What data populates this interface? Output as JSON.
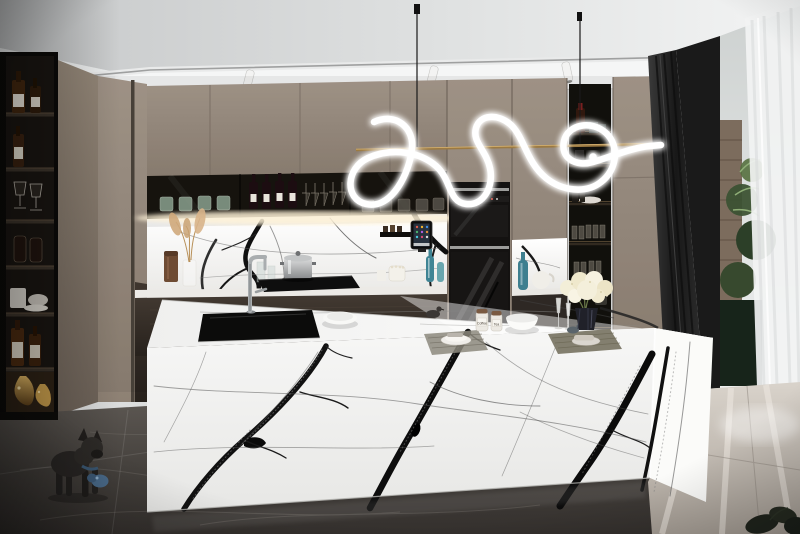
{
  "scene": {
    "description": "Photorealistic 3D render of a modern luxury kitchen: white marble waterfall island with bold black veining, taupe handleless cabinetry, dark glass display cabinets, sculptural white LED squiggle pendant on a brass bar, built-in double ovens, open decor niches, dark marble floor with a french bulldog figurine, and a sunlit floor-to-ceiling window with sheer curtains",
    "labels": {
      "coffee_jar": "Coffee",
      "tea_jar": "Tea"
    },
    "palette": {
      "ceiling": "#e6e8e8",
      "cabinet_taupe": "#a2958a",
      "cabinet_dark_wood": "#38302a",
      "marble_white": "#f5f5f4",
      "marble_vein": "#111111",
      "floor_dark": "#45413e",
      "floor_sunlit": "#c9c2b9",
      "neon_white": "#ffffff",
      "brass_bar": "#a8864f",
      "accent_teal": "#3f8494",
      "gold_decor": "#b08a3e",
      "flower_cream": "#f0e9cf",
      "curtain_dark": "#262626",
      "window_frame": "#1a1a1a",
      "plant_green": "#4a5e3f"
    },
    "objects": [
      "ceiling track spotlights",
      "LED squiggle pendant on brass bar",
      "taupe upper cabinets",
      "glass display cabinet with wine bottles and stemware",
      "white marble backsplash with black veins",
      "pampas grass in glass vase",
      "stock pot on induction cooktop",
      "tablet on wall shelf",
      "built-in double wall ovens",
      "open shelving niche with decor",
      "dark wood base cabinets",
      "marble waterfall island",
      "black undermount sink with steel faucet",
      "white serving bowls",
      "coffee and tea jars",
      "champagne flutes",
      "woven placemats with plates and cutlery",
      "hydrangea bouquet in dark vase",
      "left display shelving with spirits and glassware",
      "gold vases",
      "french bulldog figurine with blue collar",
      "dark marble floor",
      "sunlit floor by window",
      "floor-to-ceiling window with sheer curtain",
      "dark drapery",
      "outdoor greenery"
    ]
  }
}
